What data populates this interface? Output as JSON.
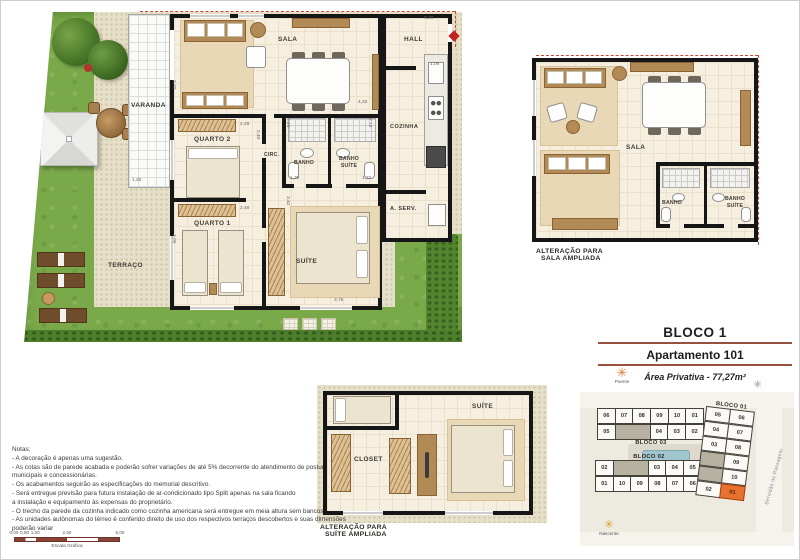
{
  "main_plan": {
    "rooms": {
      "varanda": "VARANDA",
      "terraco": "TERRAÇO",
      "sala": "SALA",
      "hall": "HALL",
      "cozinha": "COZINHA",
      "quarto2": "QUARTO 2",
      "quarto1": "QUARTO 1",
      "circ": "CIRC.",
      "banho": "BANHO",
      "banho_suite": "BANHO SUÍTE",
      "suite": "SUÍTE",
      "a_serv": "A. SERV."
    },
    "dims": [
      {
        "t": "8,20",
        "x": 424,
        "y": 16,
        "r": 0
      },
      {
        "t": "1,08",
        "x": 430,
        "y": 62,
        "r": 0
      },
      {
        "t": "2,70",
        "x": 176,
        "y": 80,
        "r": 90
      },
      {
        "t": "1,20",
        "x": 132,
        "y": 178,
        "r": 0
      },
      {
        "t": "2,48",
        "x": 240,
        "y": 122,
        "r": 0
      },
      {
        "t": "2,40",
        "x": 260,
        "y": 130,
        "r": 90
      },
      {
        "t": "4,33",
        "x": 358,
        "y": 100,
        "r": 0
      },
      {
        "t": "2,10",
        "x": 290,
        "y": 118,
        "r": 90
      },
      {
        "t": "2,10",
        "x": 372,
        "y": 118,
        "r": 90
      },
      {
        "t": "1,30",
        "x": 290,
        "y": 176,
        "r": 0
      },
      {
        "t": "1,32",
        "x": 362,
        "y": 176,
        "r": 0
      },
      {
        "t": "2,48",
        "x": 240,
        "y": 206,
        "r": 0
      },
      {
        "t": "3,00",
        "x": 176,
        "y": 234,
        "r": 90
      },
      {
        "t": "3,42",
        "x": 290,
        "y": 196,
        "r": 90
      },
      {
        "t": "3,75",
        "x": 334,
        "y": 298,
        "r": 0
      }
    ]
  },
  "alt_sala": {
    "caption_line1": "ALTERAÇÃO PARA",
    "caption_line2": "SALA AMPLIADA",
    "rooms": {
      "sala": "SALA",
      "banho": "BANHO",
      "banho_suite": "BANHO SUÍTE"
    }
  },
  "alt_suite": {
    "caption_line1": "ALTERAÇÃO PARA",
    "caption_line2": "SUÍTE AMPLIADA",
    "rooms": {
      "closet": "CLOSET",
      "suite": "SUÍTE"
    }
  },
  "info": {
    "bloco_title": "BLOCO 1",
    "apartment_title": "Apartamento 101",
    "area_text": "Área Privativa - 77,27m²",
    "poente_label": "Poente",
    "nascente_label": "Nascente"
  },
  "site_plan": {
    "bloco1": {
      "label": "BLOCO 01",
      "rows": [
        [
          "05",
          "06"
        ],
        [
          "04",
          "07"
        ],
        [
          "03",
          "08"
        ],
        [
          "#",
          "09"
        ],
        [
          "#",
          "10"
        ],
        [
          "02",
          "01"
        ]
      ]
    },
    "bloco2": {
      "label": "BLOCO 02",
      "row1": [
        "02",
        "#",
        "03",
        "04",
        "05"
      ],
      "row2": [
        "01",
        "10",
        "09",
        "08",
        "07",
        "06"
      ]
    },
    "bloco3": {
      "label": "BLOCO 03",
      "row1": [
        "06",
        "07",
        "08",
        "09",
        "10",
        "01"
      ],
      "row2": [
        "05",
        "#",
        "04",
        "03",
        "02"
      ]
    },
    "highlighted_unit": "01",
    "street_label": "Servidão de Passagem"
  },
  "notes": {
    "title": "Notas:",
    "lines": [
      "- A decoração é apenas uma sugestão.",
      "- As cotas são de parede acabada e poderão sofrer variações de até 5% decorrente  do atendimento de posturas",
      "municipais e concessionárias.",
      "- Os acabamentos seguirão as especificações do memorial descritivo.",
      "- Será entregue previsão para futura instalação de ar-condicionado tipo Split apenas na sala ficando",
      "a instalação e equipamento às expensas do proprietário.",
      "- O trecho da parede da cozinha indicado como cozinha americana será entregue em meia altura sem bancos.",
      "- As unidades autônomas do térreo é conferido direito de uso dos respectivos terraços descobertos e suas dimensões",
      "poderão variar"
    ]
  },
  "scale": {
    "ticks": [
      "0,00",
      "0,50",
      "1,00",
      "2,50",
      "5,00"
    ],
    "label": "Escala Gráfica"
  },
  "colors": {
    "wall": "#161616",
    "grass": "#7aa94a",
    "gravel": "#e6dfc9",
    "floor": "#f6efe0",
    "wood": "#b18a55",
    "highlight_orange": "#e8712f",
    "boundary_red": "#cc4433",
    "underline_red": "#9a5040"
  }
}
